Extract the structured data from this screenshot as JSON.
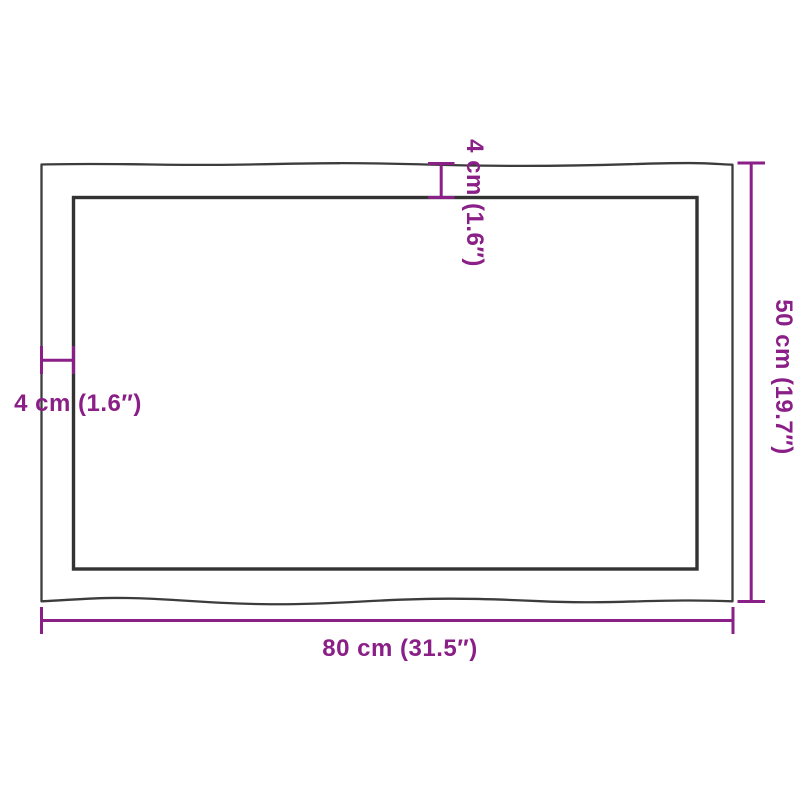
{
  "diagram": {
    "labels": {
      "width": "80 cm (31.5″)",
      "height": "50 cm (19.7″)",
      "edge_thickness_left": "4 cm (1.6″)",
      "edge_thickness_top": "4 cm (1.6″)"
    },
    "colors": {
      "dimension_accent": "#8A1F87",
      "outline_dark": "#3C3C3C",
      "inner_outline_dark": "#333333",
      "background": "#FFFFFF"
    }
  }
}
